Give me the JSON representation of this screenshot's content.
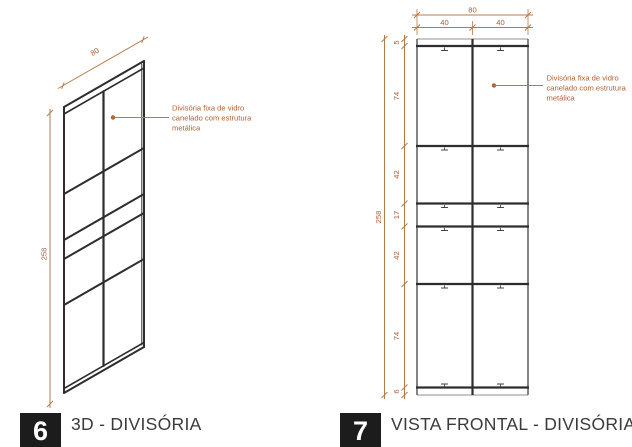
{
  "colors": {
    "dimension_line": "#b97a45",
    "dimension_text": "#ad5c2c",
    "drawing_black": "#2d2d2d",
    "drawing_gray": "#909090",
    "label_box_bg": "#1c1c1c",
    "title_text": "#3a3a3a"
  },
  "annotation": {
    "lines": [
      "Divisória fixa de vidro",
      "canelado com estrutura",
      "metálica"
    ]
  },
  "view_3d": {
    "number": "6",
    "title": "3D - DIVISÓRIA",
    "dim_width": "80",
    "dim_height": "258"
  },
  "view_frontal": {
    "number": "7",
    "title": "VISTA FRONTAL - DIVISÓRIA",
    "dim_width": "80",
    "dim_half_left": "40",
    "dim_half_right": "40",
    "dim_height": "258",
    "chain": [
      "5",
      "74",
      "42",
      "17",
      "42",
      "74",
      "6"
    ]
  }
}
